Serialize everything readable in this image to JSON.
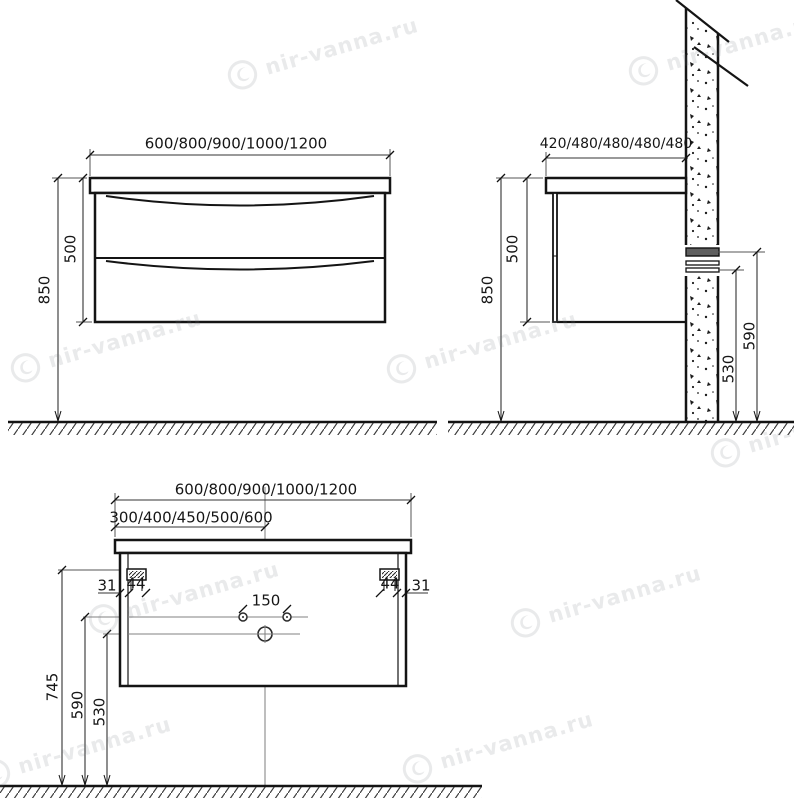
{
  "watermark": {
    "text": "nir-vanna.ru",
    "logo_icon": "nir-vanna-logo"
  },
  "views": {
    "front": {
      "title": "front view",
      "width_options": "600/800/900/1000/1200",
      "cabinet_height": "500",
      "mount_height": "850"
    },
    "side": {
      "title": "side view",
      "depth_options": "420/480/480/480/480",
      "cabinet_height": "500",
      "mount_height": "850",
      "rail_upper_height": "590",
      "rail_lower_height": "530"
    },
    "rear": {
      "title": "rear view",
      "width_options": "600/800/900/1000/1200",
      "center_offset_options": "300/400/450/500/600",
      "bracket_offset_left": "31",
      "bracket_offset_right": "31",
      "bracket_width_left": "44",
      "bracket_width_right": "44",
      "faucet_holes_spacing": "150",
      "bracket_height": "745",
      "holes_height": "590",
      "drain_height": "530"
    }
  }
}
